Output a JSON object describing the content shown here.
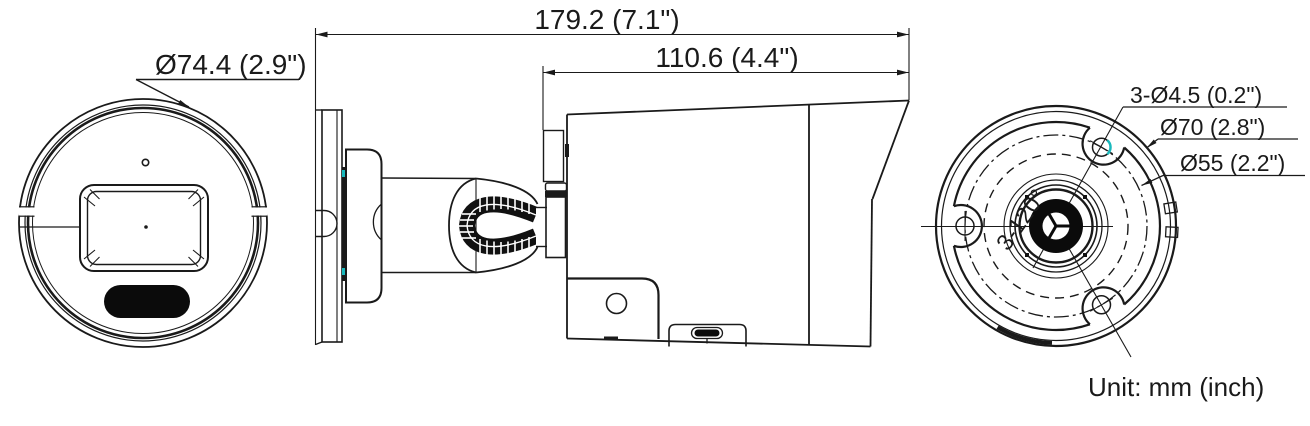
{
  "drawing": {
    "unit_note": "Unit: mm (inch)",
    "dims": {
      "overall_length": "179.2 (7.1\")",
      "front_length": "110.6 (4.4\")",
      "front_diameter": "Ø74.4 (2.9\")",
      "mount_holes": "3-Ø4.5 (0.2\")",
      "circle_70": "Ø70 (2.8\")",
      "circle_55": "Ø55 (2.2\")",
      "hole_angle": "3-120°"
    },
    "colors": {
      "line": "#1a1a1a",
      "accent": "#19b9bd"
    }
  }
}
